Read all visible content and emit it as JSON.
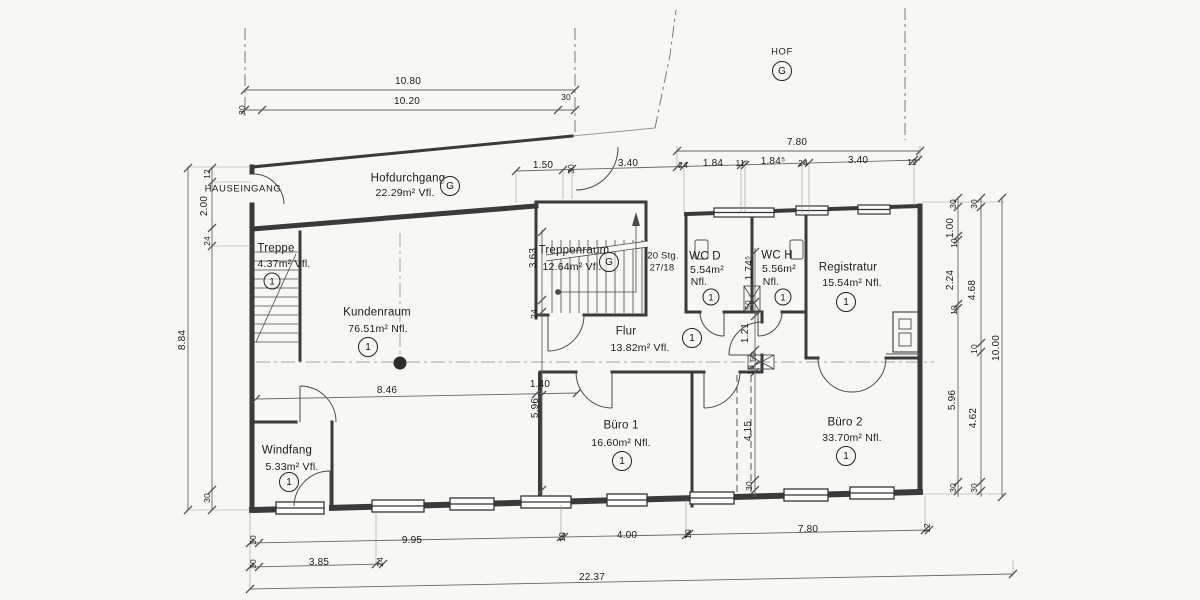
{
  "page": {
    "background": "#f7f7f4",
    "wall_color": "#3a3a3a",
    "dim_color": "#666666",
    "text_color": "#1c1c1c"
  },
  "labels": {
    "hauseingang": "HAUSEINGANG"
  },
  "rooms": {
    "hof": {
      "name": "HOF",
      "zone": "G"
    },
    "hofdurchgang": {
      "name": "Hofdurchgang",
      "area": "22.29m² Vfl.",
      "zone": "G"
    },
    "treppe": {
      "name": "Treppe",
      "area": "4.37m² Vfl.",
      "zone": "1"
    },
    "kundenraum": {
      "name": "Kundenraum",
      "area": "76.51m² Nfl.",
      "zone": "1"
    },
    "treppenraum": {
      "name": "Treppenraum",
      "area": "12.64m² Vfl.",
      "zone": "G",
      "stair_note_line1": "20 Stg.",
      "stair_note_line2": "27/18"
    },
    "flur": {
      "name": "Flur",
      "area": "13.82m² Vfl.",
      "zone": "1"
    },
    "wc_d": {
      "name": "WC D",
      "area": "5.54m²",
      "unit": "Nfl.",
      "zone": "1"
    },
    "wc_h": {
      "name": "WC H",
      "area": "5.56m²",
      "unit": "Nfl.",
      "zone": "1"
    },
    "registratur": {
      "name": "Registratur",
      "area": "15.54m² Nfl.",
      "zone": "1"
    },
    "buero1": {
      "name": "Büro 1",
      "area": "16.60m² Nfl.",
      "zone": "1"
    },
    "buero2": {
      "name": "Büro 2",
      "area": "33.70m² Nfl.",
      "zone": "1"
    },
    "windfang": {
      "name": "Windfang",
      "area": "5.33m² Vfl.",
      "zone": "1"
    }
  },
  "dims": {
    "top_outer": "10.80",
    "top_inner": "10.20",
    "top_30_left": "30",
    "top_30_right": "30",
    "left_outer": "8.84",
    "left_12": "12",
    "left_200": "2.00",
    "left_24": "24",
    "left_30": "30",
    "hof_total": "7.80",
    "mid_150": "1.50",
    "mid_30": "30",
    "mid_340": "3.40",
    "hof_24a": "24",
    "hof_184a": "1.84",
    "hof_115": "11⁵",
    "hof_184b": "1.84⁵",
    "hof_24b": "24",
    "hof_340": "3.40",
    "hof_12": "12",
    "h_846": "8.46",
    "h_140": "1.40",
    "c535_363": "3.63",
    "c535_24": "24",
    "c535_596": "5.96",
    "c755_174": "1.74⁵",
    "c755_50a": "50",
    "c755_121": "1.21",
    "c755_50b": "50",
    "c755_10": "10",
    "c755_415": "4.15",
    "c755_30": "30",
    "r1_30a": "30",
    "r1_100": "1.00",
    "r1_10a": "10",
    "r1_224": "2.24",
    "r1_10b": "10",
    "r1_596": "5.96",
    "r1_30b": "30",
    "r2_30a": "30",
    "r2_468": "4.68",
    "r2_10": "10",
    "r2_462": "4.62",
    "r2_30b": "30",
    "r3_total": "10.00",
    "b1_30": "30",
    "b1_995": "9.95",
    "b1_10a": "10",
    "b1_400": "4.00",
    "b1_10b": "10",
    "b1_780": "7.80",
    "b1_12": "12",
    "b2_30": "30",
    "b2_385": "3.85",
    "b2_24": "24",
    "b3_total": "22.37"
  }
}
